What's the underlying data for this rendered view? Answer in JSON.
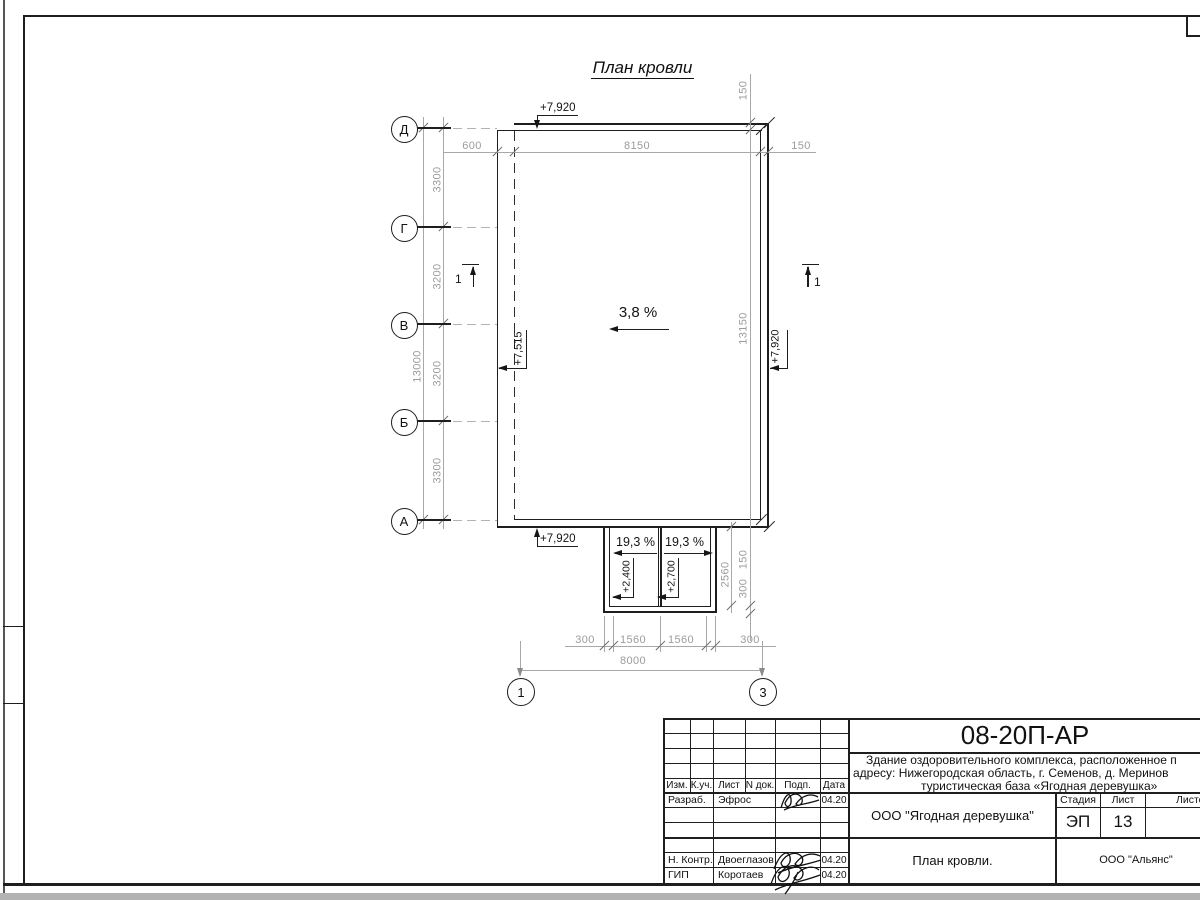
{
  "sheet": {
    "title": "План кровли",
    "slopes": {
      "main": "3,8 %",
      "canopy_left": "19,3 %",
      "canopy_right": "19,3 %"
    },
    "elevations": {
      "top": "+7,920",
      "left": "+7,515",
      "right": "+7,920",
      "bottom": "+7,920",
      "canopy_left": "+2,400",
      "canopy_right": "+2,700"
    },
    "section_mark_left": "1",
    "section_mark_right": "1",
    "axes_rows": [
      "Д",
      "Г",
      "В",
      "Б",
      "А"
    ],
    "axes_cols": [
      "1",
      "3"
    ],
    "dims": {
      "top": [
        "600",
        "8150",
        "150"
      ],
      "left_spans": [
        "3300",
        "3200",
        "3200",
        "3300"
      ],
      "left_total": "13000",
      "right_top": "150",
      "right_total": "13150",
      "right_lower": [
        "150",
        "300"
      ],
      "canopy_depth": "2560",
      "bottom_spans": [
        "300",
        "1560",
        "1560",
        "300"
      ],
      "bottom_total": "8000"
    }
  },
  "titleblock": {
    "doc_number": "08-20П-АР",
    "project_lines": [
      "Здание оздоровительного комплекса, расположенное п",
      "адресу: Нижегородская область, г. Семенов, д. Меринов",
      "туристическая база «Ягодная деревушка»"
    ],
    "rev_headers": [
      "Изм.",
      "К.уч.",
      "Лист",
      "N док.",
      "Подп.",
      "Дата"
    ],
    "roles": [
      {
        "role": "Разраб.",
        "name": "Эфрос",
        "date": "04.20"
      },
      {
        "role": "Н. Контр.",
        "name": "Двоеглазов",
        "date": "04.20"
      },
      {
        "role": "ГИП",
        "name": "Коротаев",
        "date": "04.20"
      }
    ],
    "stage_headers": [
      "Стадия",
      "Лист",
      "Листов"
    ],
    "stage": "ЭП",
    "sheet_number": "13",
    "company": "ООО \"Ягодная деревушка\"",
    "sheet_title": "План кровли.",
    "contractor": "ООО \"Альянс\""
  }
}
